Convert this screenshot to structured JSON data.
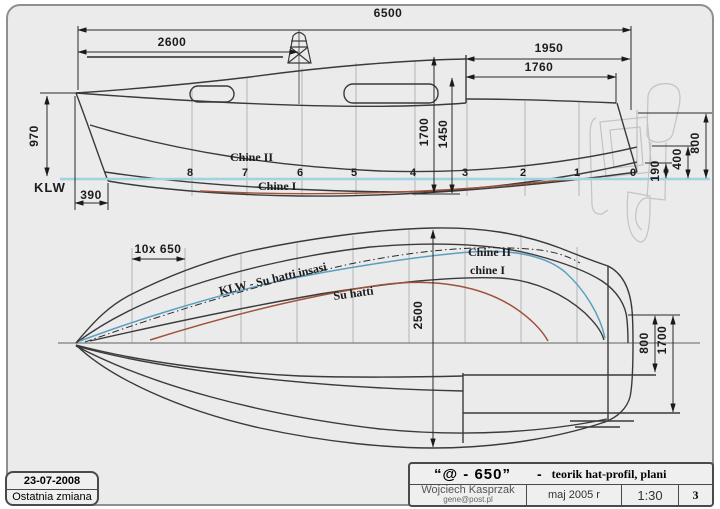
{
  "side_view": {
    "dims": {
      "overall": "6500",
      "mast": "2600",
      "aft1": "1950",
      "aft2": "1760",
      "bow_height": "970",
      "forefoot": "390",
      "h1700": "1700",
      "h1450": "1450",
      "t800": "800",
      "t400": "400",
      "t190": "190"
    },
    "labels": {
      "waterline": "KLW",
      "chine2": "Chine II",
      "chine1": "Chine I"
    },
    "stations": [
      "8",
      "7",
      "6",
      "5",
      "4",
      "3",
      "2",
      "1",
      "0"
    ]
  },
  "plan_view": {
    "dims": {
      "spacing": "10x  650",
      "beam": "2500",
      "p800": "800",
      "p1700": "1700"
    },
    "labels": {
      "klw_line": "KLW - Su hatti insasi",
      "waterline": "Su hatti",
      "chine2": "Chine II",
      "chine1": "chine I"
    }
  },
  "title_block": {
    "title": "“@ - 650”",
    "dash": "-",
    "subtitle": "teorik hat-profil, plani",
    "author": "Wojciech Kasprzak",
    "email": "gene@post.pl",
    "date": "maj 2005 r",
    "scale": "1:30",
    "sheet": "3"
  },
  "revision_box": {
    "date": "23-07-2008",
    "label": "Ostatnia zmiana"
  },
  "colors": {
    "waterline": "#9fd3e0",
    "chine_blue": "#5b9fc0",
    "chine_red": "#a0523d",
    "line": "#3a3a3a",
    "station": "#b5b5b5",
    "ghost": "#c3c3c3",
    "paper": "#ebebeb"
  }
}
